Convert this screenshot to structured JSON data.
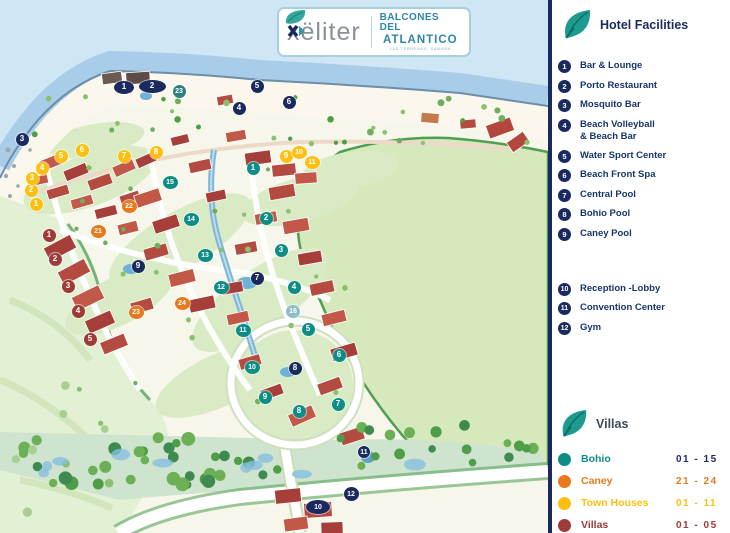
{
  "logo": {
    "brand": "xëliter",
    "property_line1": "BALCONES DEL",
    "property_line2": "ATLANTICO",
    "tagline": "LAS TERRENAS, SAMANA"
  },
  "sidebar": {
    "facilities": {
      "title": "Hotel Facilities",
      "items": [
        {
          "num": "1",
          "label": "Bar & Lounge"
        },
        {
          "num": "2",
          "label": "Porto Restaurant"
        },
        {
          "num": "3",
          "label": "Mosquito Bar"
        },
        {
          "num": "4",
          "label": "Beach Volleyball",
          "label2": "& Beach Bar"
        },
        {
          "num": "5",
          "label": "Water Sport Center"
        },
        {
          "num": "6",
          "label": "Beach Front Spa"
        },
        {
          "num": "7",
          "label": "Central Pool"
        },
        {
          "num": "8",
          "label": "Bohio Pool"
        },
        {
          "num": "9",
          "label": "Caney Pool"
        },
        {
          "num": "10",
          "label": "Reception -Lobby",
          "gap_before": true
        },
        {
          "num": "11",
          "label": "Convention Center"
        },
        {
          "num": "12",
          "label": "Gym"
        }
      ]
    },
    "villas": {
      "title": "Villas",
      "categories": [
        {
          "name": "Bohio",
          "range": "01 - 15",
          "color": "#0e8c86",
          "range_color": "#1b2a5e"
        },
        {
          "name": "Caney",
          "range": "21 - 24",
          "color": "#e8791d",
          "range_color": "#e8791d"
        },
        {
          "name": "Town Houses",
          "range": "01 - 11",
          "color": "#fdc010",
          "range_color": "#fdc010"
        },
        {
          "name": "Villas",
          "range": "01 - 05",
          "color": "#9e3a38",
          "range_color": "#9e3a38"
        }
      ]
    }
  },
  "map": {
    "marker_colors": {
      "facility": "#1b2a5e",
      "bohio": "#0e8c86",
      "bohio_pale": "#8fbdc8",
      "bohio_dark": "#2b7f86",
      "caney": "#e8791d",
      "townhouse": "#fdc010",
      "villa": "#9e3a38"
    },
    "markers": [
      {
        "cat": "facility",
        "n": "1",
        "x": 124,
        "y": 87,
        "w": 20,
        "h": 13
      },
      {
        "cat": "facility",
        "n": "2",
        "x": 152,
        "y": 86,
        "w": 27,
        "h": 13
      },
      {
        "cat": "facility",
        "n": "3",
        "x": 22,
        "y": 139
      },
      {
        "cat": "facility",
        "n": "4",
        "x": 239,
        "y": 108
      },
      {
        "cat": "facility",
        "n": "5",
        "x": 257,
        "y": 86
      },
      {
        "cat": "facility",
        "n": "6",
        "x": 289,
        "y": 102
      },
      {
        "cat": "facility",
        "n": "7",
        "x": 257,
        "y": 278
      },
      {
        "cat": "facility",
        "n": "8",
        "x": 295,
        "y": 368
      },
      {
        "cat": "facility",
        "n": "9",
        "x": 138,
        "y": 266
      },
      {
        "cat": "facility",
        "n": "10",
        "x": 318,
        "y": 507,
        "w": 24,
        "h": 14
      },
      {
        "cat": "facility",
        "n": "11",
        "x": 364,
        "y": 452,
        "w": 12,
        "h": 12
      },
      {
        "cat": "facility",
        "n": "12",
        "x": 351,
        "y": 494,
        "w": 15,
        "h": 14
      },
      {
        "cat": "bohio_dark",
        "n": "23",
        "x": 179,
        "y": 91
      },
      {
        "cat": "bohio",
        "n": "1",
        "x": 253,
        "y": 168
      },
      {
        "cat": "bohio",
        "n": "2",
        "x": 266,
        "y": 218
      },
      {
        "cat": "bohio",
        "n": "3",
        "x": 281,
        "y": 250
      },
      {
        "cat": "bohio",
        "n": "4",
        "x": 294,
        "y": 287
      },
      {
        "cat": "bohio",
        "n": "5",
        "x": 308,
        "y": 329
      },
      {
        "cat": "bohio",
        "n": "6",
        "x": 339,
        "y": 355
      },
      {
        "cat": "bohio",
        "n": "7",
        "x": 338,
        "y": 404
      },
      {
        "cat": "bohio",
        "n": "8",
        "x": 299,
        "y": 411
      },
      {
        "cat": "bohio",
        "n": "9",
        "x": 265,
        "y": 397
      },
      {
        "cat": "bohio",
        "n": "10",
        "x": 252,
        "y": 367,
        "w": 15
      },
      {
        "cat": "bohio",
        "n": "11",
        "x": 243,
        "y": 330,
        "w": 15
      },
      {
        "cat": "bohio",
        "n": "12",
        "x": 221,
        "y": 287,
        "w": 15
      },
      {
        "cat": "bohio",
        "n": "13",
        "x": 205,
        "y": 255,
        "w": 15
      },
      {
        "cat": "bohio",
        "n": "14",
        "x": 191,
        "y": 219,
        "w": 15
      },
      {
        "cat": "bohio",
        "n": "15",
        "x": 170,
        "y": 182,
        "w": 15
      },
      {
        "cat": "bohio_pale",
        "n": "16",
        "x": 293,
        "y": 311,
        "w": 14
      },
      {
        "cat": "caney",
        "n": "21",
        "x": 98,
        "y": 231,
        "w": 15
      },
      {
        "cat": "caney",
        "n": "22",
        "x": 129,
        "y": 206,
        "w": 15
      },
      {
        "cat": "caney",
        "n": "23",
        "x": 136,
        "y": 312,
        "w": 15
      },
      {
        "cat": "caney",
        "n": "24",
        "x": 182,
        "y": 303,
        "w": 15
      },
      {
        "cat": "townhouse",
        "n": "1",
        "x": 36,
        "y": 204
      },
      {
        "cat": "townhouse",
        "n": "2",
        "x": 31,
        "y": 190
      },
      {
        "cat": "townhouse",
        "n": "3",
        "x": 32,
        "y": 178
      },
      {
        "cat": "townhouse",
        "n": "4",
        "x": 42,
        "y": 168
      },
      {
        "cat": "townhouse",
        "n": "5",
        "x": 61,
        "y": 156
      },
      {
        "cat": "townhouse",
        "n": "6",
        "x": 82,
        "y": 150
      },
      {
        "cat": "townhouse",
        "n": "7",
        "x": 124,
        "y": 156
      },
      {
        "cat": "townhouse",
        "n": "8",
        "x": 156,
        "y": 152
      },
      {
        "cat": "townhouse",
        "n": "9",
        "x": 286,
        "y": 156
      },
      {
        "cat": "townhouse",
        "n": "10",
        "x": 299,
        "y": 152,
        "w": 15
      },
      {
        "cat": "townhouse",
        "n": "11",
        "x": 312,
        "y": 162,
        "w": 15
      },
      {
        "cat": "villa",
        "n": "1",
        "x": 49,
        "y": 235
      },
      {
        "cat": "villa",
        "n": "2",
        "x": 55,
        "y": 259
      },
      {
        "cat": "villa",
        "n": "3",
        "x": 68,
        "y": 286
      },
      {
        "cat": "villa",
        "n": "4",
        "x": 78,
        "y": 311
      },
      {
        "cat": "villa",
        "n": "5",
        "x": 90,
        "y": 339
      }
    ]
  }
}
